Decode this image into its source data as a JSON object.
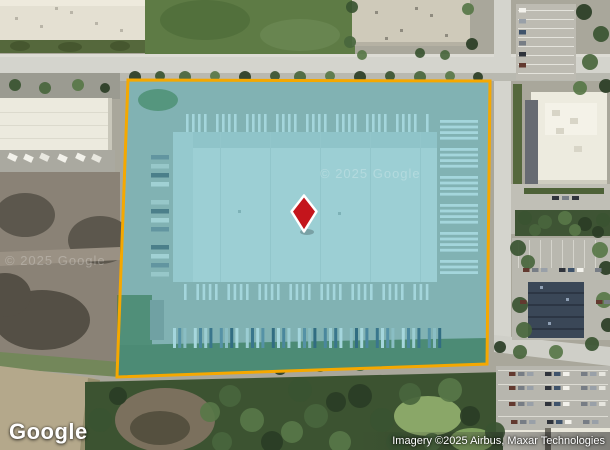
{
  "map": {
    "google_logo": "Google",
    "attribution": "Imagery ©2025 Airbus, Maxar Technologies",
    "watermark_center": "© 2025 Google",
    "watermark_left": "© 2025 Google",
    "parcel": {
      "points": "128,80 490,81 487,364 117,377",
      "outline_color": "#F5A800",
      "fill_color": "rgba(45,170,190,0.38)",
      "marker_color": "#C4151C"
    }
  }
}
